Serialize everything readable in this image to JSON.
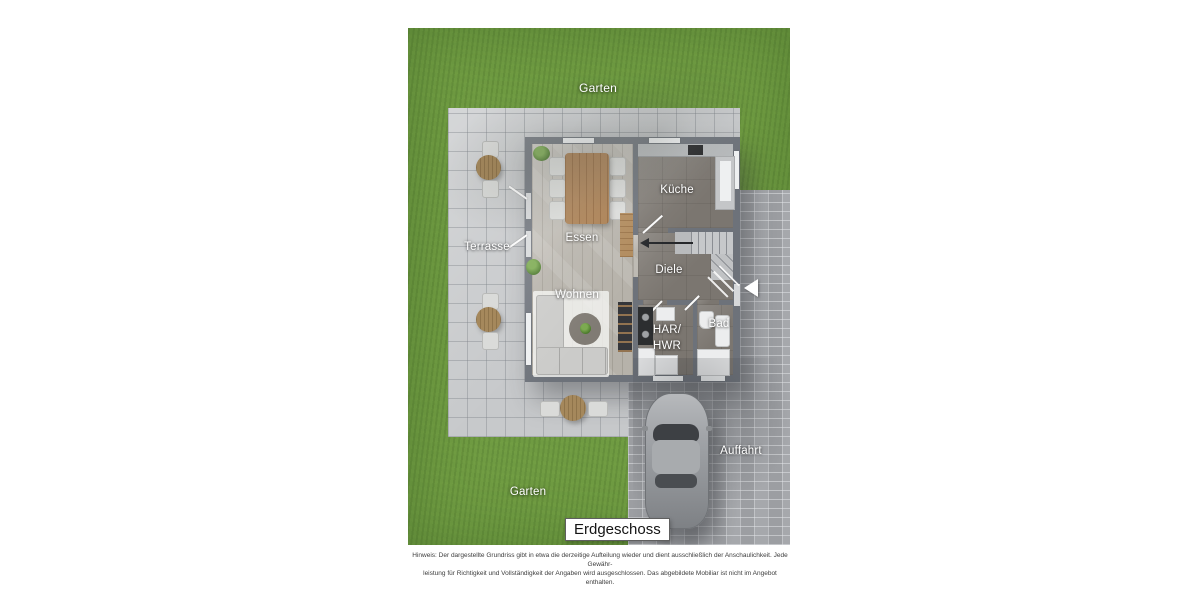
{
  "floor_plan": {
    "title": "Erdgeschoss",
    "areas": {
      "garten_top": "Garten",
      "garten_bottom": "Garten",
      "terrasse": "Terrasse",
      "auffahrt": "Auffahrt"
    },
    "rooms": {
      "essen": "Essen",
      "kueche": "Küche",
      "diele": "Diele",
      "wohnen": "Wohnen",
      "har_line1": "HAR/",
      "har_line2": "HWR",
      "bad": "Bad"
    },
    "disclaimer_line1": "Hinweis: Der dargestellte Grundriss gibt in etwa die derzeitige Aufteilung wieder und dient ausschließlich der Anschaulichkeit. Jede Gewähr-",
    "disclaimer_line2": "leistung für Richtigkeit und Vollständigkeit der Angaben wird ausgeschlossen. Das abgebildete Mobiliar ist nicht im Angebot enthalten.",
    "colors": {
      "grass": "#6f9b42",
      "terrace_pavers": "#c7c9cb",
      "driveway_cobbles": "#a6a8ac",
      "wall": "#6d727a",
      "wood_floor": "#b6b2aa",
      "dark_floor": "#7b7670",
      "label_text": "#ffffff"
    }
  }
}
